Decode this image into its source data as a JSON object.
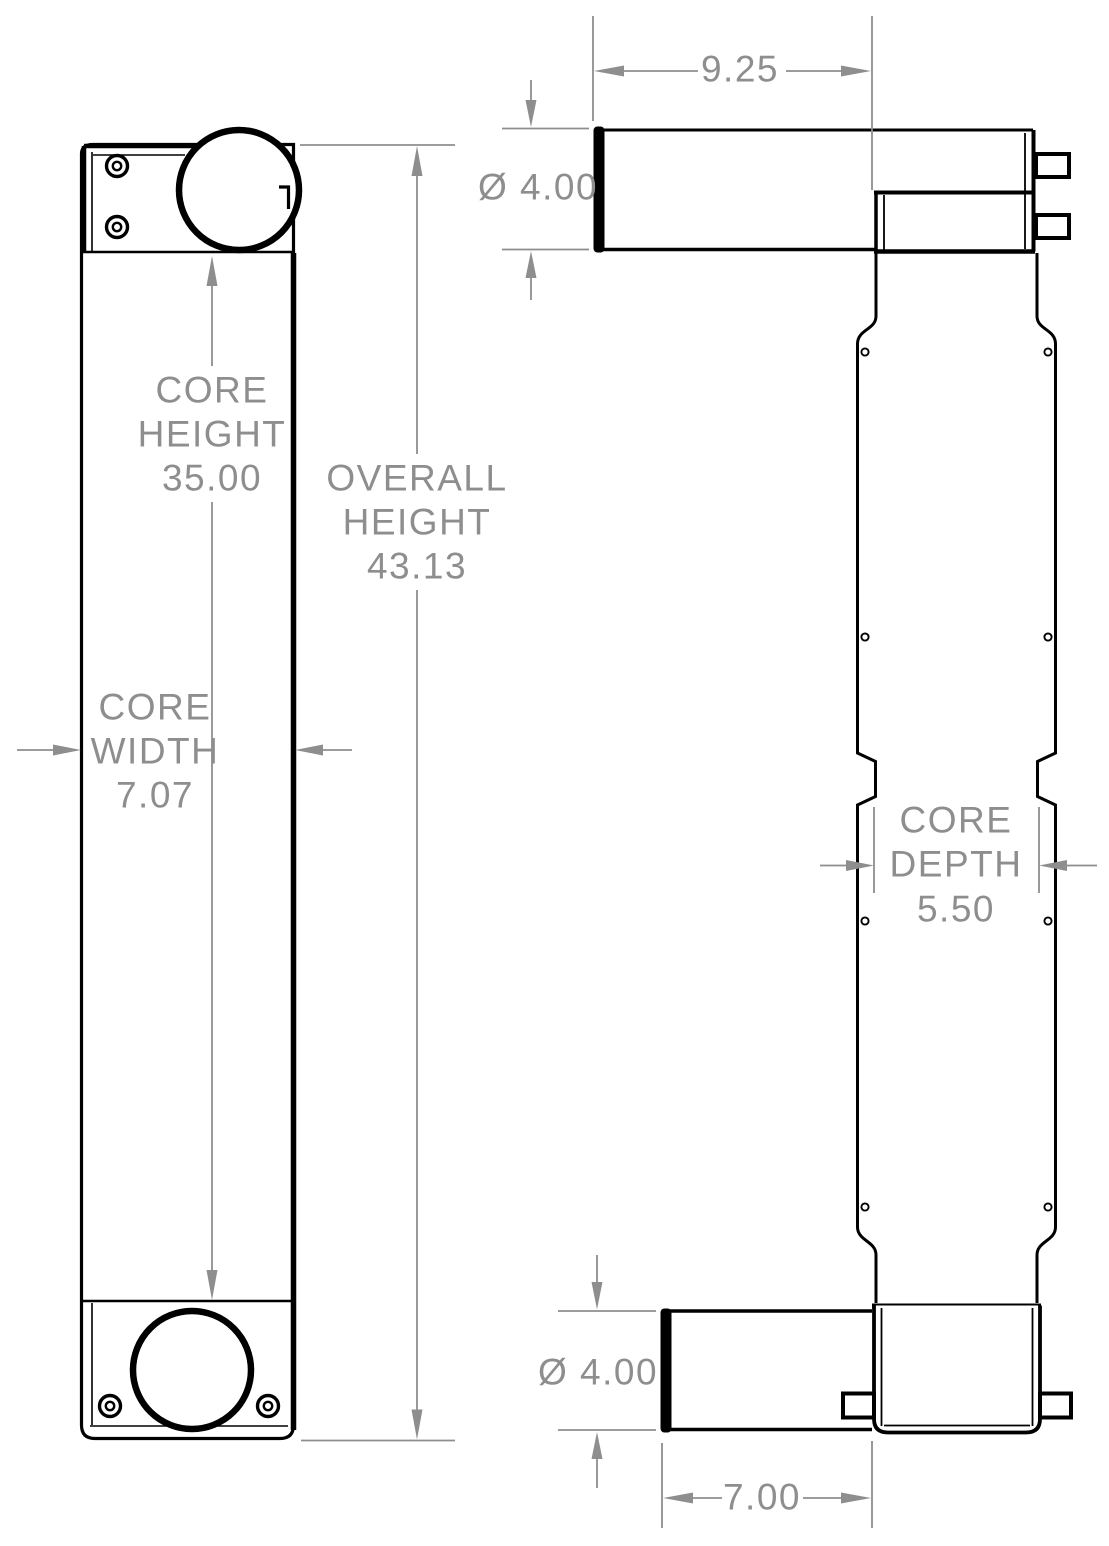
{
  "drawing": {
    "description": "Two-view engineering drawing of a vertical heat exchanger core with top and bottom round ports",
    "colors": {
      "outline": "#000000",
      "dimension": "#8e8e8e",
      "background": "#ffffff"
    }
  },
  "front_view": {
    "core_height": {
      "line1": "CORE",
      "line2": "HEIGHT",
      "value": "35.00"
    },
    "overall_height": {
      "line1": "OVERALL",
      "line2": "HEIGHT",
      "value": "43.13"
    },
    "core_width": {
      "line1": "CORE",
      "line2": "WIDTH",
      "value": "7.07"
    }
  },
  "side_view": {
    "top_pipe_length": {
      "value": "9.25"
    },
    "top_pipe_diameter": {
      "value": "Ø 4.00"
    },
    "core_depth": {
      "line1": "CORE",
      "line2": "DEPTH",
      "value": "5.50"
    },
    "bottom_pipe_diameter": {
      "value": "Ø 4.00"
    },
    "bottom_pipe_length": {
      "value": "7.00"
    }
  }
}
